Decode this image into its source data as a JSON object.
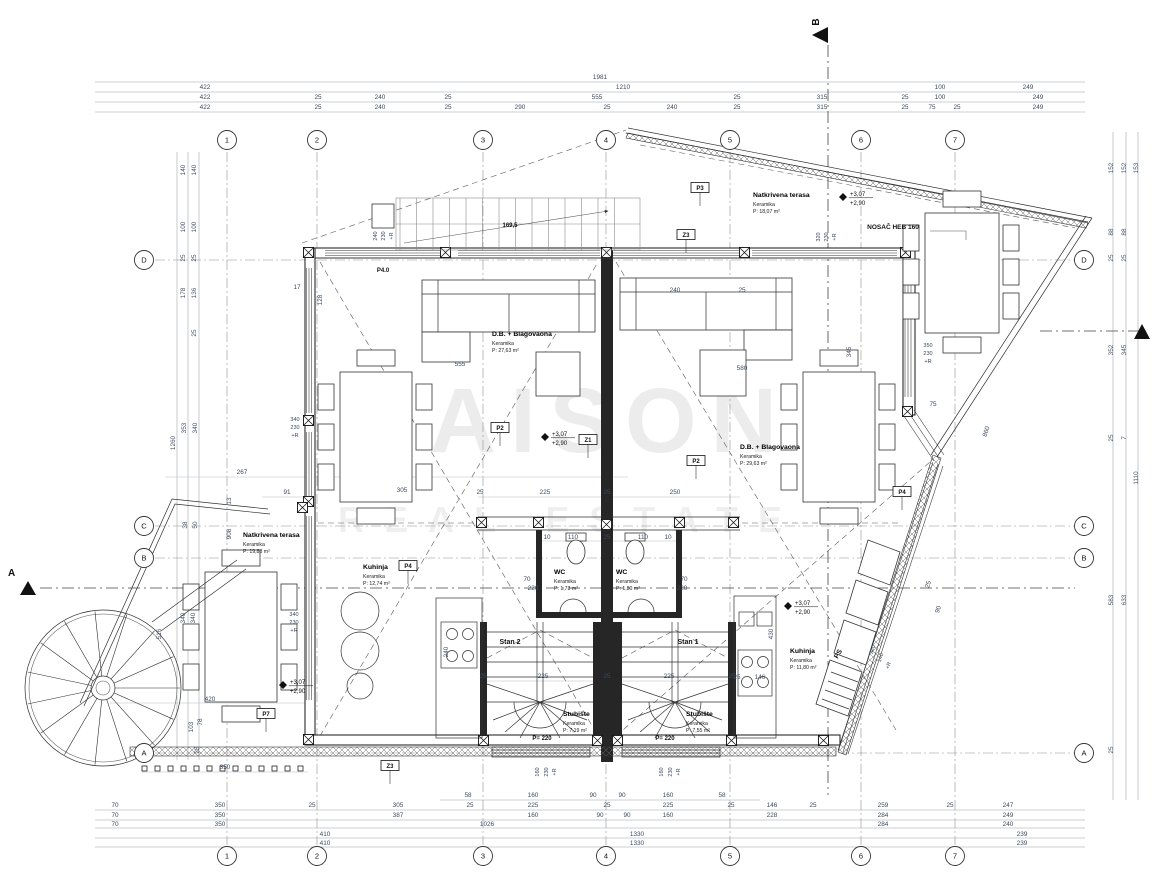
{
  "watermark": {
    "line1": "MAISON",
    "line2": "REAL ESTATE"
  },
  "grid": {
    "columns": [
      "1",
      "2",
      "3",
      "4",
      "5",
      "6",
      "7"
    ],
    "rows": [
      "D",
      "C",
      "B",
      "A"
    ]
  },
  "section_markers": {
    "top": "B",
    "left": "A"
  },
  "beam_label": "NOSAČ HEB 160",
  "rooms": [
    {
      "name": "D.B. + Blagovaona",
      "material": "Keramika",
      "area": "P: 27,63 m²",
      "x": 492,
      "y": 336
    },
    {
      "name": "D.B. + Blagovaona",
      "material": "Keramika",
      "area": "P: 29,63 m²",
      "x": 740,
      "y": 449
    },
    {
      "name": "Natkrivena terasa",
      "material": "Keramika",
      "area": "P: 18,07 m²",
      "x": 753,
      "y": 197
    },
    {
      "name": "Natkrivena terasa",
      "material": "Keramika",
      "area": "P: 19,88 m²",
      "x": 243,
      "y": 537
    },
    {
      "name": "Kuhinja",
      "material": "Keramika",
      "area": "P: 12,74 m²",
      "x": 363,
      "y": 569
    },
    {
      "name": "Kuhinja",
      "material": "Keramika",
      "area": "P: 11,80 m²",
      "x": 790,
      "y": 653
    },
    {
      "name": "WC",
      "material": "Keramika",
      "area": "P: 1,73 m²",
      "x": 554,
      "y": 574
    },
    {
      "name": "WC",
      "material": "Keramika",
      "area": "P: 1,80 m²",
      "x": 616,
      "y": 574
    },
    {
      "name": "Stubište",
      "material": "Keramika",
      "area": "P: 7,19 m²",
      "x": 563,
      "y": 716
    },
    {
      "name": "Stubište",
      "material": "Keramika",
      "area": "P: 7,55 m²",
      "x": 686,
      "y": 716
    }
  ],
  "box_labels": [
    [
      "P2",
      500,
      430
    ],
    [
      "Z1",
      588,
      442
    ],
    [
      "P2",
      696,
      463
    ],
    [
      "P3",
      700,
      190
    ],
    [
      "Z3",
      686,
      237
    ],
    [
      "P4",
      408,
      568
    ],
    [
      "P4",
      902,
      494
    ],
    [
      "P7",
      266,
      716
    ],
    [
      "Z3",
      390,
      768
    ]
  ],
  "level_markers": {
    "upper": "+3,07",
    "lower": "+2,90",
    "points": [
      [
        545,
        437
      ],
      [
        843,
        197
      ],
      [
        788,
        606
      ],
      [
        283,
        685
      ]
    ]
  },
  "annotations": [
    [
      "1981",
      600,
      79
    ],
    [
      "422",
      205,
      89
    ],
    [
      "1210",
      623,
      89
    ],
    [
      "100",
      940,
      89
    ],
    [
      "249",
      1028,
      89
    ],
    [
      "422",
      205,
      99
    ],
    [
      "25",
      318,
      99
    ],
    [
      "240",
      380,
      99
    ],
    [
      "25",
      448,
      99
    ],
    [
      "555",
      597,
      99
    ],
    [
      "25",
      737,
      99
    ],
    [
      "315",
      822,
      99
    ],
    [
      "25",
      905,
      99
    ],
    [
      "100",
      940,
      99
    ],
    [
      "249",
      1038,
      99
    ],
    [
      "422",
      205,
      109
    ],
    [
      "25",
      318,
      109
    ],
    [
      "240",
      380,
      109
    ],
    [
      "25",
      448,
      109
    ],
    [
      "290",
      520,
      109
    ],
    [
      "25",
      607,
      109
    ],
    [
      "240",
      672,
      109
    ],
    [
      "25",
      737,
      109
    ],
    [
      "315",
      822,
      109
    ],
    [
      "25",
      905,
      109
    ],
    [
      "75",
      932,
      109
    ],
    [
      "25",
      957,
      109
    ],
    [
      "249",
      1038,
      109
    ],
    [
      "58",
      468,
      797
    ],
    [
      "160",
      533,
      797
    ],
    [
      "90",
      593,
      797
    ],
    [
      "90",
      622,
      797
    ],
    [
      "160",
      668,
      797
    ],
    [
      "58",
      722,
      797
    ],
    [
      "70",
      115,
      807
    ],
    [
      "350",
      220,
      807
    ],
    [
      "25",
      312,
      807
    ],
    [
      "305",
      398,
      807
    ],
    [
      "25",
      470,
      807
    ],
    [
      "225",
      533,
      807
    ],
    [
      "25",
      607,
      807
    ],
    [
      "225",
      668,
      807
    ],
    [
      "25",
      731,
      807
    ],
    [
      "146",
      772,
      807
    ],
    [
      "25",
      813,
      807
    ],
    [
      "259",
      883,
      807
    ],
    [
      "25",
      950,
      807
    ],
    [
      "247",
      1008,
      807
    ],
    [
      "70",
      115,
      817
    ],
    [
      "350",
      220,
      817
    ],
    [
      "387",
      398,
      817
    ],
    [
      "160",
      533,
      817
    ],
    [
      "90",
      600,
      817
    ],
    [
      "90",
      627,
      817
    ],
    [
      "160",
      668,
      817
    ],
    [
      "228",
      772,
      817
    ],
    [
      "284",
      883,
      817
    ],
    [
      "249",
      1008,
      817
    ],
    [
      "70",
      115,
      826
    ],
    [
      "350",
      220,
      826
    ],
    [
      "1026",
      487,
      826
    ],
    [
      "284",
      883,
      826
    ],
    [
      "240",
      1008,
      826
    ],
    [
      "410",
      325,
      836
    ],
    [
      "1330",
      637,
      836
    ],
    [
      "239",
      1022,
      836
    ],
    [
      "410",
      325,
      845
    ],
    [
      "1330",
      637,
      845
    ],
    [
      "239",
      1022,
      845
    ],
    [
      "140",
      185,
      170,
      -90
    ],
    [
      "140",
      196,
      170,
      -90
    ],
    [
      "100",
      185,
      227,
      -90
    ],
    [
      "100",
      196,
      227,
      -90
    ],
    [
      "25",
      185,
      258,
      -90
    ],
    [
      "25",
      196,
      258,
      -90
    ],
    [
      "178",
      185,
      293,
      -90
    ],
    [
      "136",
      196,
      293,
      -90
    ],
    [
      "25",
      196,
      333,
      -90
    ],
    [
      "1260",
      175,
      443,
      -90
    ],
    [
      "353",
      186,
      428,
      -90
    ],
    [
      "340",
      197,
      428,
      -90
    ],
    [
      "13",
      231,
      501,
      -90
    ],
    [
      "38",
      187,
      525,
      -90
    ],
    [
      "50",
      197,
      525,
      -90
    ],
    [
      "908",
      231,
      534,
      -90
    ],
    [
      "340",
      185,
      618,
      -90
    ],
    [
      "340",
      195,
      618,
      -90
    ],
    [
      "516",
      161,
      634,
      -90
    ],
    [
      "103",
      193,
      727,
      -90
    ],
    [
      "78",
      202,
      722,
      -90
    ],
    [
      "25",
      199,
      750,
      -90
    ],
    [
      "267",
      242,
      474
    ],
    [
      "91",
      287,
      494
    ],
    [
      "17",
      297,
      289
    ],
    [
      "420",
      210,
      701
    ],
    [
      "350",
      225,
      769
    ],
    [
      "340",
      295,
      421,
      0,
      5.5
    ],
    [
      "230",
      295,
      429,
      0,
      5.5
    ],
    [
      "+R",
      295,
      437,
      0,
      5.5
    ],
    [
      "340",
      294,
      616,
      0,
      5.5
    ],
    [
      "230",
      294,
      624,
      0,
      5.5
    ],
    [
      "+R",
      294,
      632,
      0,
      5.5
    ],
    [
      "240",
      377,
      236,
      -90,
      5.5
    ],
    [
      "230",
      385,
      236,
      -90,
      5.5
    ],
    [
      "+R",
      393,
      236,
      -90,
      5.5
    ],
    [
      "128",
      322,
      300,
      -90
    ],
    [
      "152",
      1113,
      168,
      -90
    ],
    [
      "152",
      1126,
      168,
      -90
    ],
    [
      "153",
      1138,
      168,
      -90
    ],
    [
      "88",
      1113,
      232,
      -90
    ],
    [
      "88",
      1126,
      232,
      -90
    ],
    [
      "25",
      1113,
      258,
      -90
    ],
    [
      "25",
      1126,
      258,
      -90
    ],
    [
      "352",
      1113,
      350,
      -90
    ],
    [
      "345",
      1126,
      350,
      -90
    ],
    [
      "25",
      1113,
      438,
      -90
    ],
    [
      "7",
      1126,
      438,
      -90
    ],
    [
      "1110",
      1138,
      478,
      -90
    ],
    [
      "583",
      1113,
      600,
      -90
    ],
    [
      "633",
      1126,
      600,
      -90
    ],
    [
      "25",
      1113,
      750,
      -90
    ],
    [
      "860",
      988,
      432,
      -72
    ],
    [
      "90",
      940,
      610,
      -72
    ],
    [
      "25",
      930,
      585,
      -72
    ],
    [
      "75",
      933,
      406
    ],
    [
      "350",
      928,
      347,
      0,
      5.5
    ],
    [
      "230",
      928,
      355,
      0,
      5.5
    ],
    [
      "+R",
      928,
      363,
      0,
      5.5
    ],
    [
      "345",
      851,
      352,
      -90
    ],
    [
      "240",
      675,
      292
    ],
    [
      "25",
      742,
      292
    ],
    [
      "555",
      460,
      366
    ],
    [
      "580",
      742,
      370
    ],
    [
      "305",
      402,
      492
    ],
    [
      "25",
      480,
      494
    ],
    [
      "225",
      545,
      494
    ],
    [
      "25",
      607,
      494
    ],
    [
      "250",
      675,
      494
    ],
    [
      "10",
      547,
      539
    ],
    [
      "110",
      573,
      539
    ],
    [
      "25",
      607,
      539
    ],
    [
      "110",
      643,
      539
    ],
    [
      "10",
      668,
      539
    ],
    [
      "70",
      527,
      581
    ],
    [
      "220",
      533,
      590
    ],
    [
      "70",
      684,
      581
    ],
    [
      "220",
      682,
      590
    ],
    [
      "25",
      483,
      678
    ],
    [
      "225",
      543,
      678
    ],
    [
      "25",
      607,
      678
    ],
    [
      "225",
      669,
      678
    ],
    [
      "25",
      732,
      678
    ],
    [
      "160",
      539,
      772,
      -90,
      5.5
    ],
    [
      "230",
      548,
      772,
      -90,
      5.5
    ],
    [
      "+R",
      556,
      772,
      -90,
      5.5
    ],
    [
      "160",
      663,
      772,
      -90,
      5.5
    ],
    [
      "230",
      672,
      772,
      -90,
      5.5
    ],
    [
      "+R",
      680,
      772,
      -90,
      5.5
    ],
    [
      "430",
      773,
      634,
      -90
    ],
    [
      "146",
      760,
      679
    ],
    [
      "25",
      737,
      679
    ],
    [
      "340",
      874,
      650,
      -72,
      5.5
    ],
    [
      "140",
      882,
      658,
      -72,
      5.5
    ],
    [
      "+R",
      890,
      666,
      -72,
      5.5
    ],
    [
      "240",
      448,
      652,
      -90
    ],
    [
      "169,5",
      510,
      227,
      0,
      6,
      1
    ],
    [
      "320",
      820,
      237,
      -90,
      5.5
    ],
    [
      "230",
      828,
      237,
      -90,
      5.5
    ],
    [
      "+R",
      836,
      237,
      -90,
      5.5
    ],
    [
      "NOSAČ HEB 160",
      893,
      229,
      0,
      6.5,
      1
    ],
    [
      "P= 220",
      542,
      740,
      0,
      6,
      1
    ],
    [
      "P= 220",
      665,
      740,
      0,
      6,
      1
    ],
    [
      "Stan 2",
      510,
      644,
      0,
      7,
      1
    ],
    [
      "Stan 1",
      688,
      644,
      0,
      7,
      1
    ],
    [
      "PS",
      840,
      655,
      -60,
      7,
      1
    ],
    [
      "P4.0",
      383,
      272,
      0,
      6,
      1
    ]
  ]
}
